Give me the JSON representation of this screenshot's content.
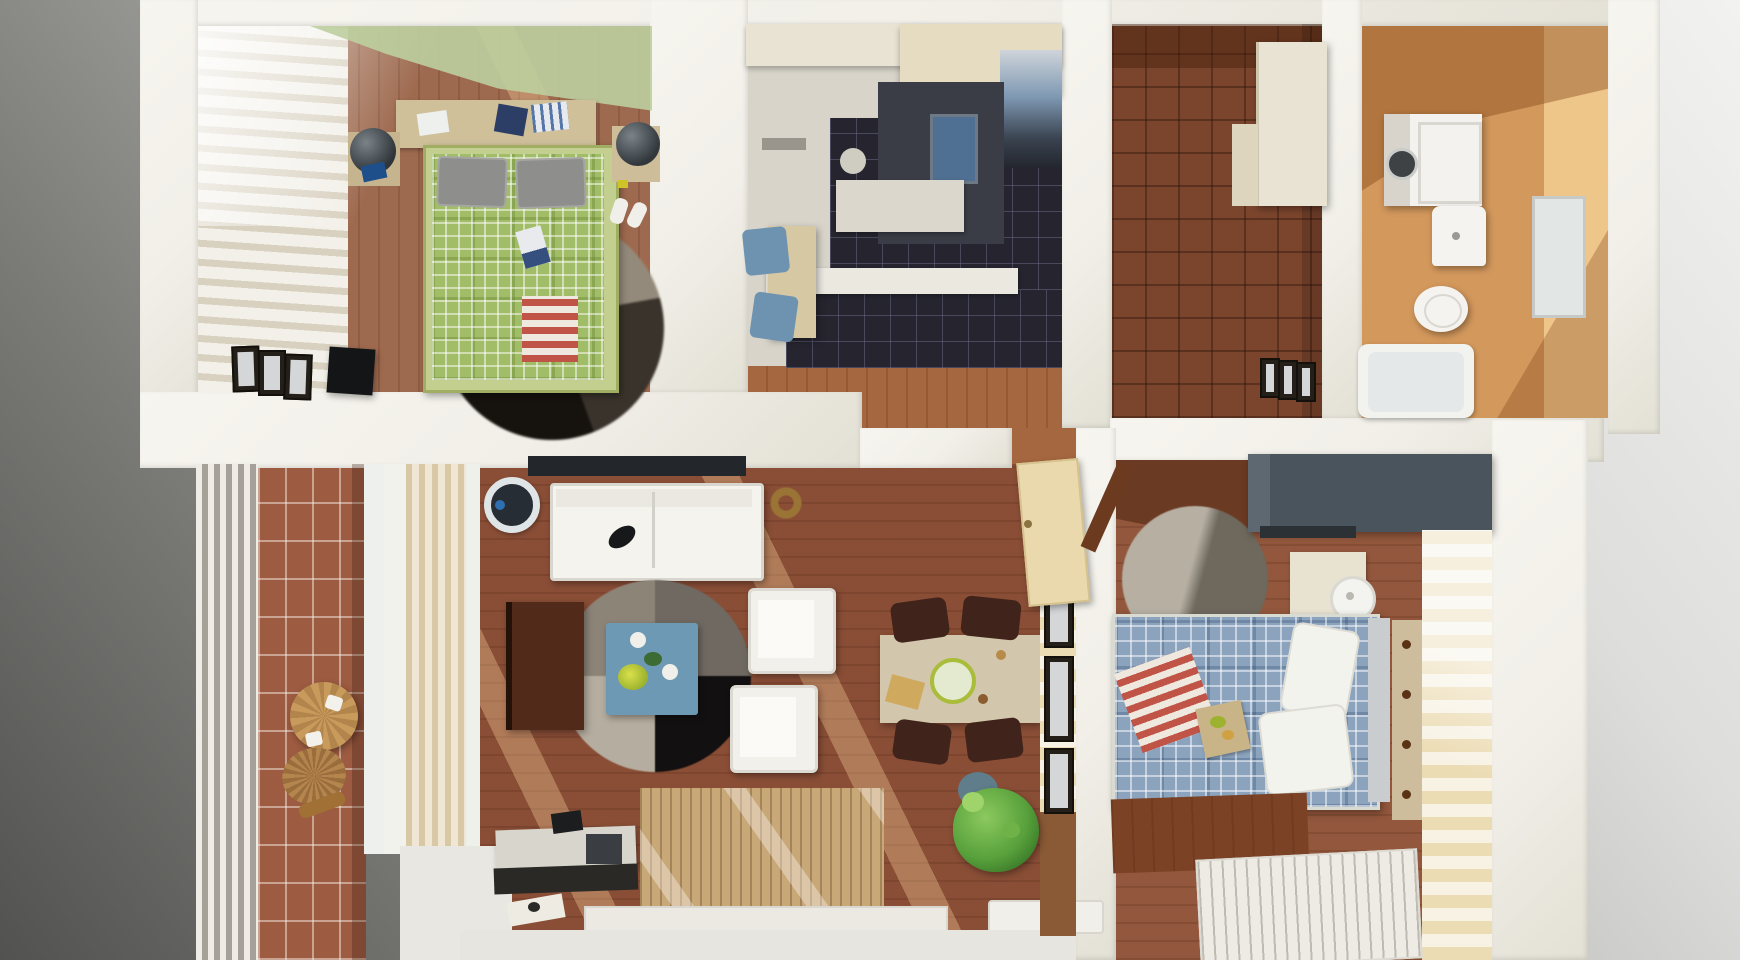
{
  "scene": {
    "type": "3d-floorplan-render",
    "view": "top-down",
    "description": "3D rendered bird's-eye floor plan of a two-bedroom apartment on a gray gradient backdrop",
    "palette": {
      "bg_dark": "#525250",
      "bg_light": "#ebebe9",
      "wall": "#f1efe8",
      "bedroom1_floor": "#9e6a4f",
      "green_accent": "#bccf9f",
      "bed1_plaid": "#a2bd68",
      "dark_rug": "#221d18",
      "kitchen_floor": "#d8d4ca",
      "kitchen_tile": "#26252f",
      "cabinet_cream": "#e9e3d3",
      "counter_dark": "#3a3d46",
      "entry_floor": "#7b452d",
      "bathroom_floor": "#d3985c",
      "bathroom_wall": "#efc68a",
      "balcony_tile": "#9d5b41",
      "living_floor": "#8a4e36",
      "sofa_white": "#f4f3ee",
      "coffee_table_blue": "#6d99b5",
      "rug_quarter_tr": "#6f6961",
      "rug_quarter_br": "#121010",
      "rug_quarter_bl": "#b5ad9f",
      "rug_quarter_tl": "#8d8478",
      "dining_table": "#d2c6ad",
      "chair_brown": "#40231a",
      "plant_green": "#57a03b",
      "bedroom2_floor": "#92573c",
      "bed2_plaid": "#8ba3bd",
      "wardrobe_gray": "#4a545c",
      "stripe_wall": "#ecdcb4",
      "red_stripe": "#c05446",
      "curtain_tan": "#d9c8a6",
      "door_cream": "#ead9ac",
      "white_furniture": "#f2f1ec"
    },
    "rooms": [
      {
        "id": "bedroom-1",
        "position": "top-left",
        "floor": "wood",
        "items": [
          "green-plaid-double-bed",
          "gray-pillows",
          "red-striped-throw",
          "round-dark-rug",
          "left-nightstand-with-lamp",
          "right-nightstand-with-lamp",
          "headboard-shelf-with-clothes",
          "striped-window-curtains",
          "green-ceiling-light-patch",
          "picture-frames",
          "black-speaker-box",
          "slippers",
          "magazine-on-bed"
        ]
      },
      {
        "id": "kitchen",
        "position": "top-center",
        "floor": "dark-tile",
        "items": [
          "upper-cabinets",
          "fridge",
          "dark-counter-with-sink",
          "prep-counter",
          "counter-bar",
          "breakfast-table",
          "two-blue-chairs",
          "stool",
          "wall-vent"
        ]
      },
      {
        "id": "entry-hall",
        "position": "top-center-right",
        "floor": "parquet",
        "items": [
          "cream-wardrobe",
          "low-cabinet",
          "three-picture-frames"
        ]
      },
      {
        "id": "bathroom",
        "position": "top-right",
        "floor": "orange-tile",
        "items": [
          "washing-machine",
          "wash-basin",
          "toilet",
          "bathtub",
          "mirror-cabinet"
        ]
      },
      {
        "id": "balcony",
        "position": "bottom-left",
        "floor": "brick-tile",
        "items": [
          "white-railing",
          "round-wooden-table",
          "two-plates",
          "wicker-chair"
        ]
      },
      {
        "id": "living-room",
        "position": "bottom-center",
        "floor": "wood",
        "items": [
          "wall-tv",
          "white-sofa",
          "remote-on-sofa",
          "round-speaker",
          "bronze-wreath",
          "quartered-round-rug",
          "blue-coffee-table",
          "yellow-flowers",
          "two-cups",
          "two-white-armchairs",
          "dark-brown-cabinet",
          "desk-with-monitor",
          "dark-tray",
          "paper-sheet",
          "dining-table",
          "salad-plate",
          "bread-board",
          "four-dark-chairs",
          "potted-plant",
          "balcony-door-threshold",
          "window-radiator",
          "striped-wall-with-frames",
          "open-cream-door"
        ]
      },
      {
        "id": "bedroom-2",
        "position": "bottom-right",
        "floor": "wood",
        "items": [
          "blue-plaid-double-bed",
          "white-pillows",
          "red-striped-throw",
          "breakfast-tray",
          "round-gray-rug",
          "dark-gray-wardrobe",
          "round-bedside-lamp",
          "bedside-shelf",
          "drawer-nightstand",
          "striped-accent-wall",
          "white-slatted-bench",
          "wood-footboard",
          "open-brown-door"
        ]
      }
    ]
  }
}
